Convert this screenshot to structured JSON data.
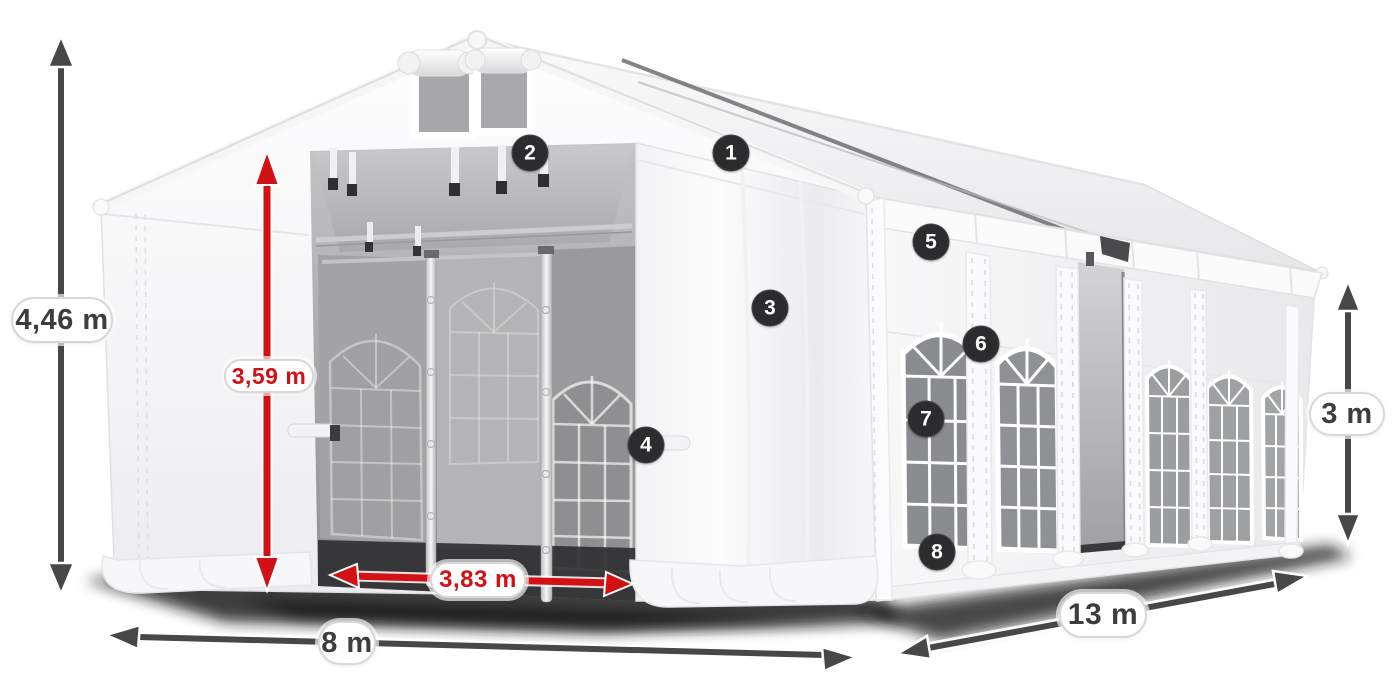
{
  "page": {
    "background": "#ffffff"
  },
  "colors": {
    "accent_red": "#d31115",
    "arrow_dark": "#474747",
    "badge_background": "#2c2c2e",
    "tent_white": "#fbfbfc"
  },
  "dimensions": [
    {
      "id": "total-height",
      "label": "4,46 m",
      "style": "dark"
    },
    {
      "id": "entrance-height",
      "label": "3,59 m",
      "style": "red"
    },
    {
      "id": "entrance-width",
      "label": "3,83 m",
      "style": "red"
    },
    {
      "id": "width",
      "label": "8 m",
      "style": "dark"
    },
    {
      "id": "length",
      "label": "13 m",
      "style": "dark"
    },
    {
      "id": "side-height",
      "label": "3 m",
      "style": "dark"
    }
  ],
  "callouts": [
    "1",
    "2",
    "3",
    "4",
    "5",
    "6",
    "7",
    "8"
  ]
}
